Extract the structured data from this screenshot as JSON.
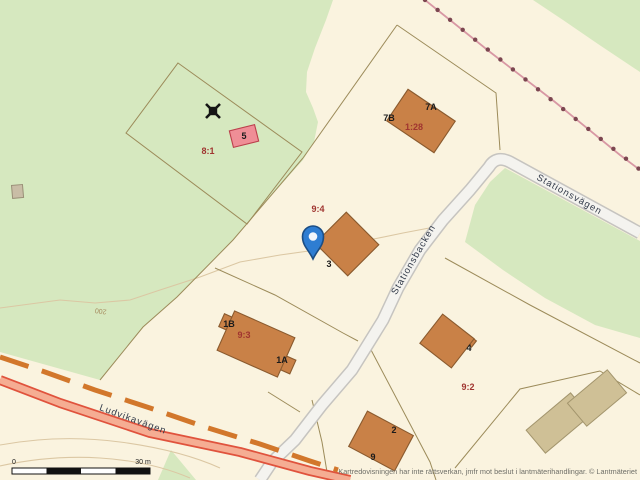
{
  "attribution": "Kartredovisningen har inte rättsverkan, jmfr mot beslut i lantmäterihandlingar. © Lantmäteriet",
  "scale_bar": {
    "start": "0",
    "end": "30 m"
  },
  "contour_label": "200",
  "road_names": [
    "Ludvikavägen",
    "Stationsbacken",
    "Stationsvägen"
  ],
  "parcel_labels": [
    "8:1",
    "9:4",
    "1:28",
    "9:3",
    "9:2"
  ],
  "house_numbers": [
    "5",
    "7A",
    "7B",
    "3",
    "1B",
    "1A",
    "4",
    "2",
    "9"
  ],
  "marker": {
    "type": "location-pin"
  },
  "colors": {
    "background_cream": "#faf3df",
    "greenspace": "#d6e8bf",
    "parcel_line": "#9c8b5a",
    "contour_line": "#dbc7a3",
    "building_fill": "#c98147",
    "building_stroke": "#8a5a2e",
    "special_building_fill": "#ef8e96",
    "special_building_stroke": "#bb3f4b",
    "outbuilding_fill": "#cfc096",
    "misc_building_fill": "#c9bda6",
    "minor_road_fill": "#f4f3ef",
    "minor_road_casing": "#c6c4c0",
    "main_road_fill": "#f5ad93",
    "main_road_casing": "#e0533d",
    "path_dash": "#d2772b",
    "railway_line": "#d898a4",
    "railway_dot": "#7c4650",
    "house_number_text": "#1b1b1b",
    "parcel_label_text": "#a03530",
    "road_label_text": "#333b4a",
    "contour_label_text": "#a68a5e",
    "attribution_text": "#6f6f68",
    "pin_fill": "#2e7dd2",
    "pin_stroke": "#1b4d84"
  }
}
